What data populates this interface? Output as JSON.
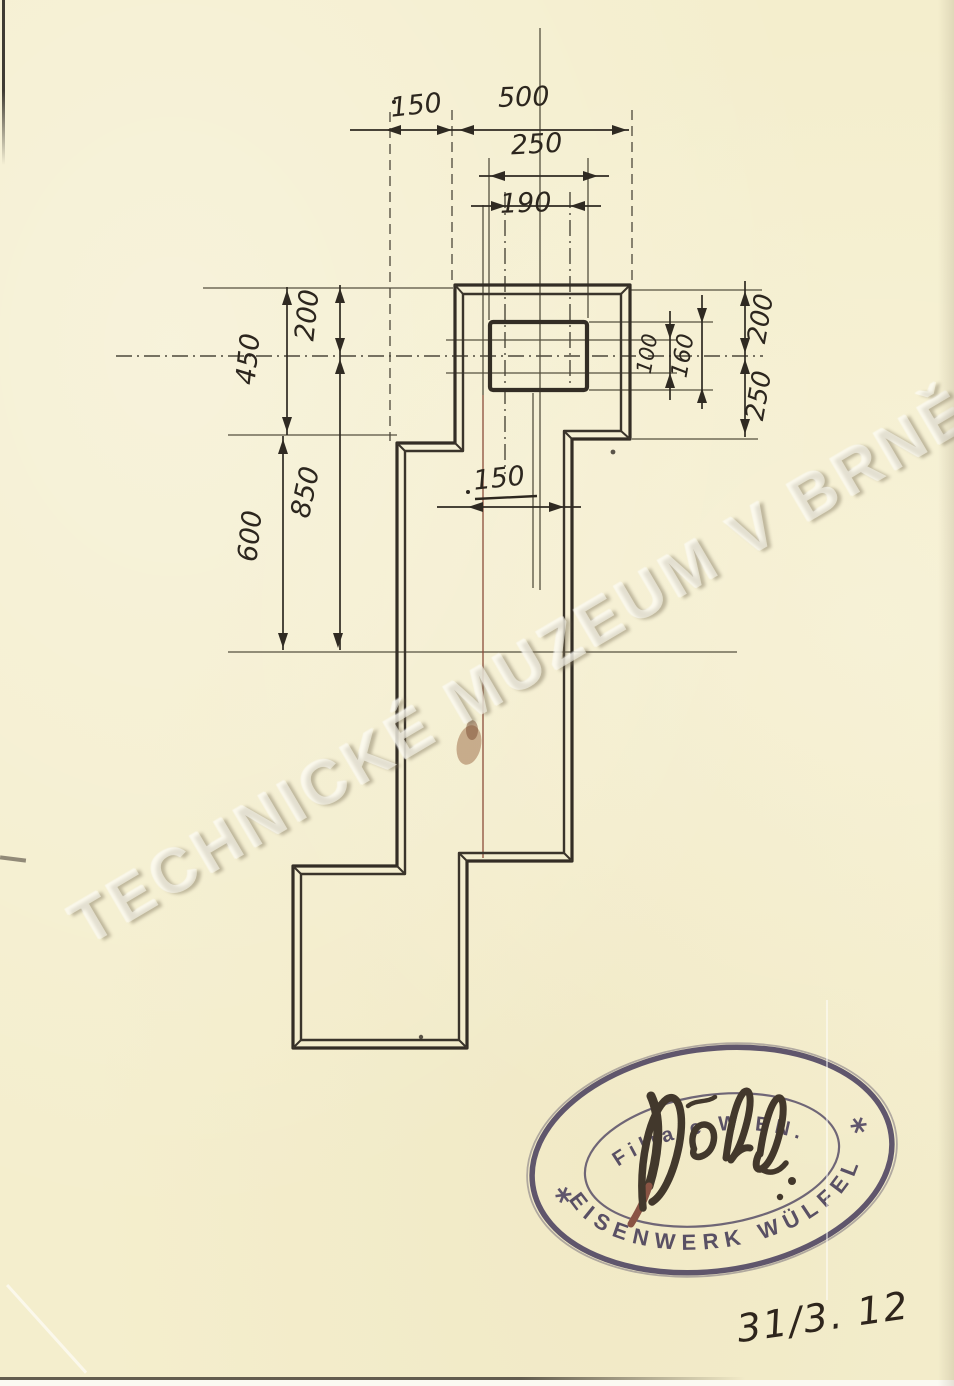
{
  "page": {
    "paper_color": "#f4eecd",
    "ink_color": "#352f27",
    "red_ink_color": "#8a4a38",
    "stamp_ink_color": "#453b57"
  },
  "watermark": {
    "text": "TECHNICKÉ MUZEUM V BRNĚ"
  },
  "drawing": {
    "dims": {
      "top_step": "150",
      "top_width": "500",
      "pocket_width": "250",
      "recess_width": "190",
      "left_total": "450",
      "left_upper": "200",
      "left_mid": "850",
      "left_lower": "600",
      "recess_height": "100",
      "pocket_height": "160",
      "right_upper": "200",
      "right_lower": "250",
      "mid_step": "150"
    }
  },
  "stamp": {
    "arc_top": "EISENWERK WÜLFEL",
    "arc_bottom": "Filiale WIEN."
  },
  "handwriting": {
    "date": "31/3. 12"
  }
}
